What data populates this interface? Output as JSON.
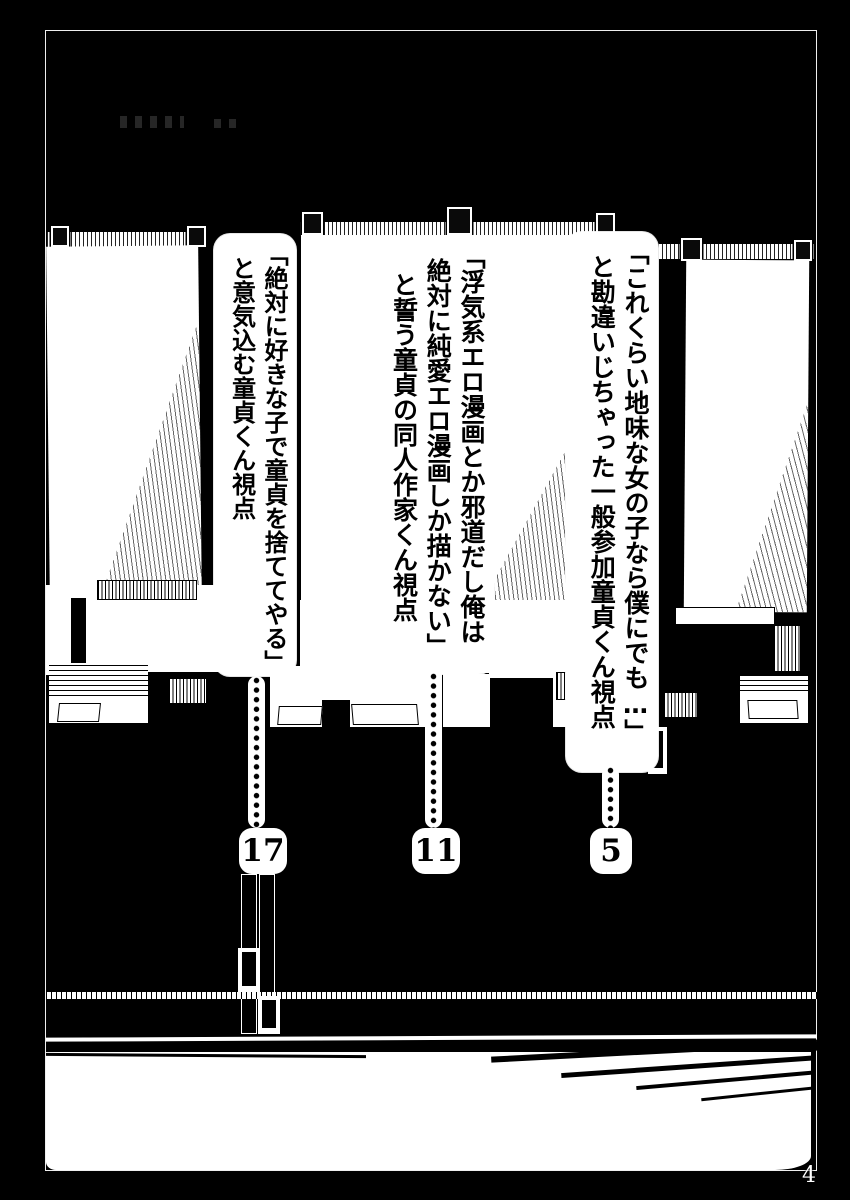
{
  "page": {
    "folio_label": "4"
  },
  "toc": {
    "entries": [
      {
        "id": "entry-1",
        "lines": [
          "「これくらい地味な女の子なら僕にでも…」",
          "と勘違いじちゃった一般参加童貞くん視点"
        ],
        "page": "5"
      },
      {
        "id": "entry-2",
        "lines": [
          "「浮気系エロ漫画とか邪道だし俺は",
          "絶対に純愛エロ漫画しか描かない」",
          "と誓う童貞の同人作家くん視点"
        ],
        "page": "11"
      },
      {
        "id": "entry-3",
        "lines": [
          "「絶対に好きな子で童貞を捨ててやる」",
          "と意気込む童貞くん視点"
        ],
        "page": "17"
      }
    ]
  },
  "colors": {
    "ink": "#000000",
    "paper": "#ffffff"
  }
}
